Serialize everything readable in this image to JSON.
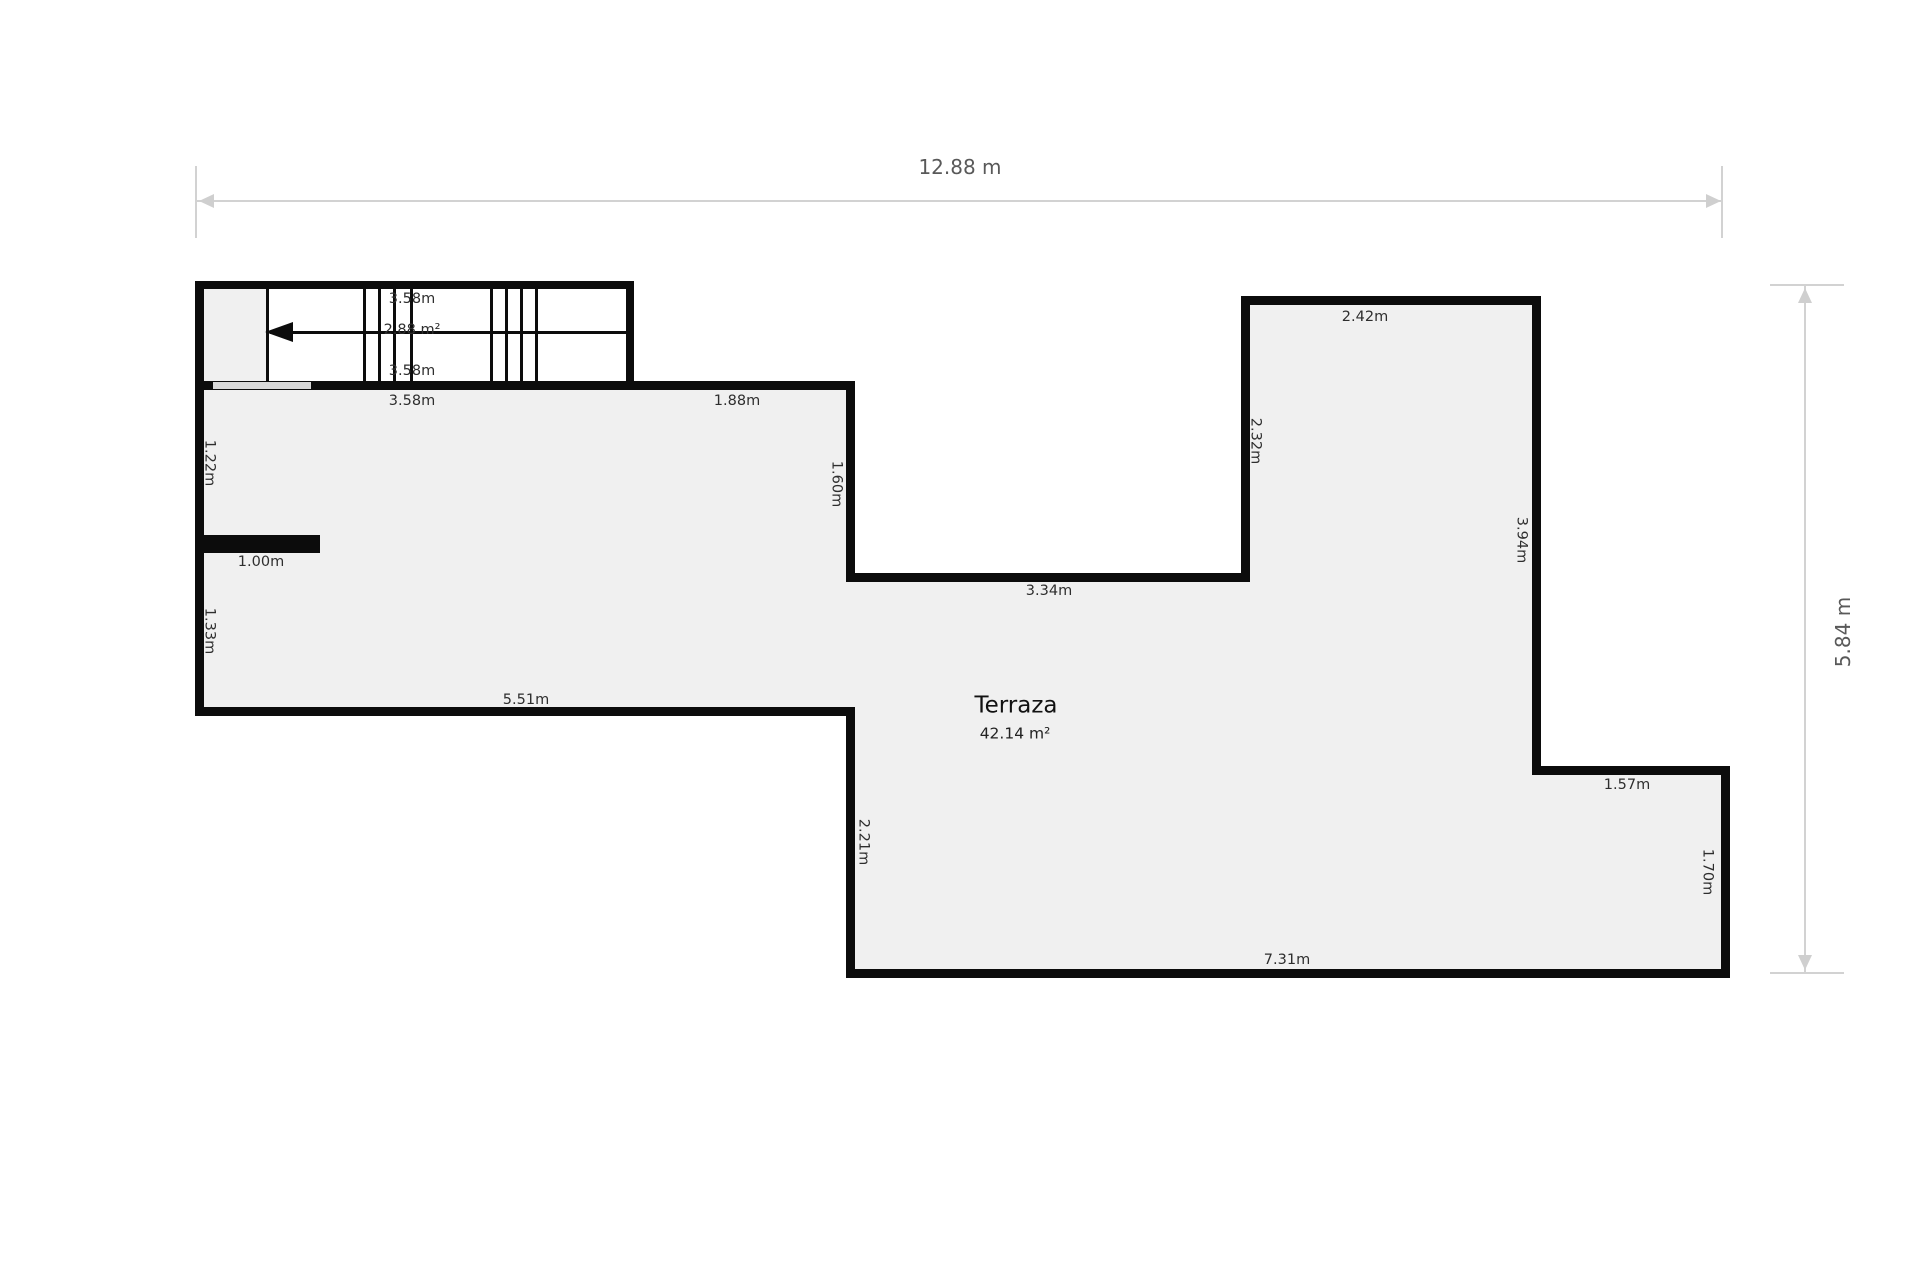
{
  "plan": {
    "room": {
      "name": "Terraza",
      "area": "42.14 m²"
    },
    "stairs": {
      "area_label": "2.88 m²",
      "top_width_label": "3.58m",
      "bottom_width_label": "3.58m"
    },
    "overall": {
      "width_label": "12.88 m",
      "height_label": "5.84 m"
    },
    "colors": {
      "wall": "#0c0c0c",
      "floor_fill": "#f0f0f0",
      "door_opening": "#d9d9d9",
      "dimension_line": "#d2d2d2",
      "dimension_text": "#595959",
      "label_text": "#2e2e2e",
      "background": "#ffffff"
    },
    "dimension_labels": [
      {
        "text": "12.88 m",
        "x": 960,
        "y": 167,
        "rot": 0,
        "variant": "overall"
      },
      {
        "text": "5.84 m",
        "x": 1843,
        "y": 632,
        "rot": -90,
        "variant": "overall"
      },
      {
        "text": "3.58m",
        "x": 412,
        "y": 299,
        "rot": 0
      },
      {
        "text": "2.88 m²",
        "x": 412,
        "y": 330,
        "rot": 0
      },
      {
        "text": "3.58m",
        "x": 412,
        "y": 371,
        "rot": 0
      },
      {
        "text": "3.58m",
        "x": 412,
        "y": 401,
        "rot": 0
      },
      {
        "text": "1.88m",
        "x": 737,
        "y": 401,
        "rot": 0
      },
      {
        "text": "1.22m",
        "x": 209,
        "y": 463,
        "rot": 90
      },
      {
        "text": "1.00m",
        "x": 261,
        "y": 562,
        "rot": 0
      },
      {
        "text": "1.33m",
        "x": 209,
        "y": 631,
        "rot": 90
      },
      {
        "text": "1.60m",
        "x": 836,
        "y": 484,
        "rot": 90
      },
      {
        "text": "3.34m",
        "x": 1049,
        "y": 591,
        "rot": 0
      },
      {
        "text": "2.32m",
        "x": 1255,
        "y": 441,
        "rot": 90
      },
      {
        "text": "2.42m",
        "x": 1365,
        "y": 317,
        "rot": 0
      },
      {
        "text": "3.94m",
        "x": 1521,
        "y": 540,
        "rot": 90
      },
      {
        "text": "1.57m",
        "x": 1627,
        "y": 785,
        "rot": 0
      },
      {
        "text": "1.70m",
        "x": 1707,
        "y": 872,
        "rot": 90
      },
      {
        "text": "2.21m",
        "x": 863,
        "y": 842,
        "rot": 90
      },
      {
        "text": "5.51m",
        "x": 526,
        "y": 700,
        "rot": 0
      },
      {
        "text": "7.31m",
        "x": 1287,
        "y": 960,
        "rot": 0
      }
    ]
  }
}
